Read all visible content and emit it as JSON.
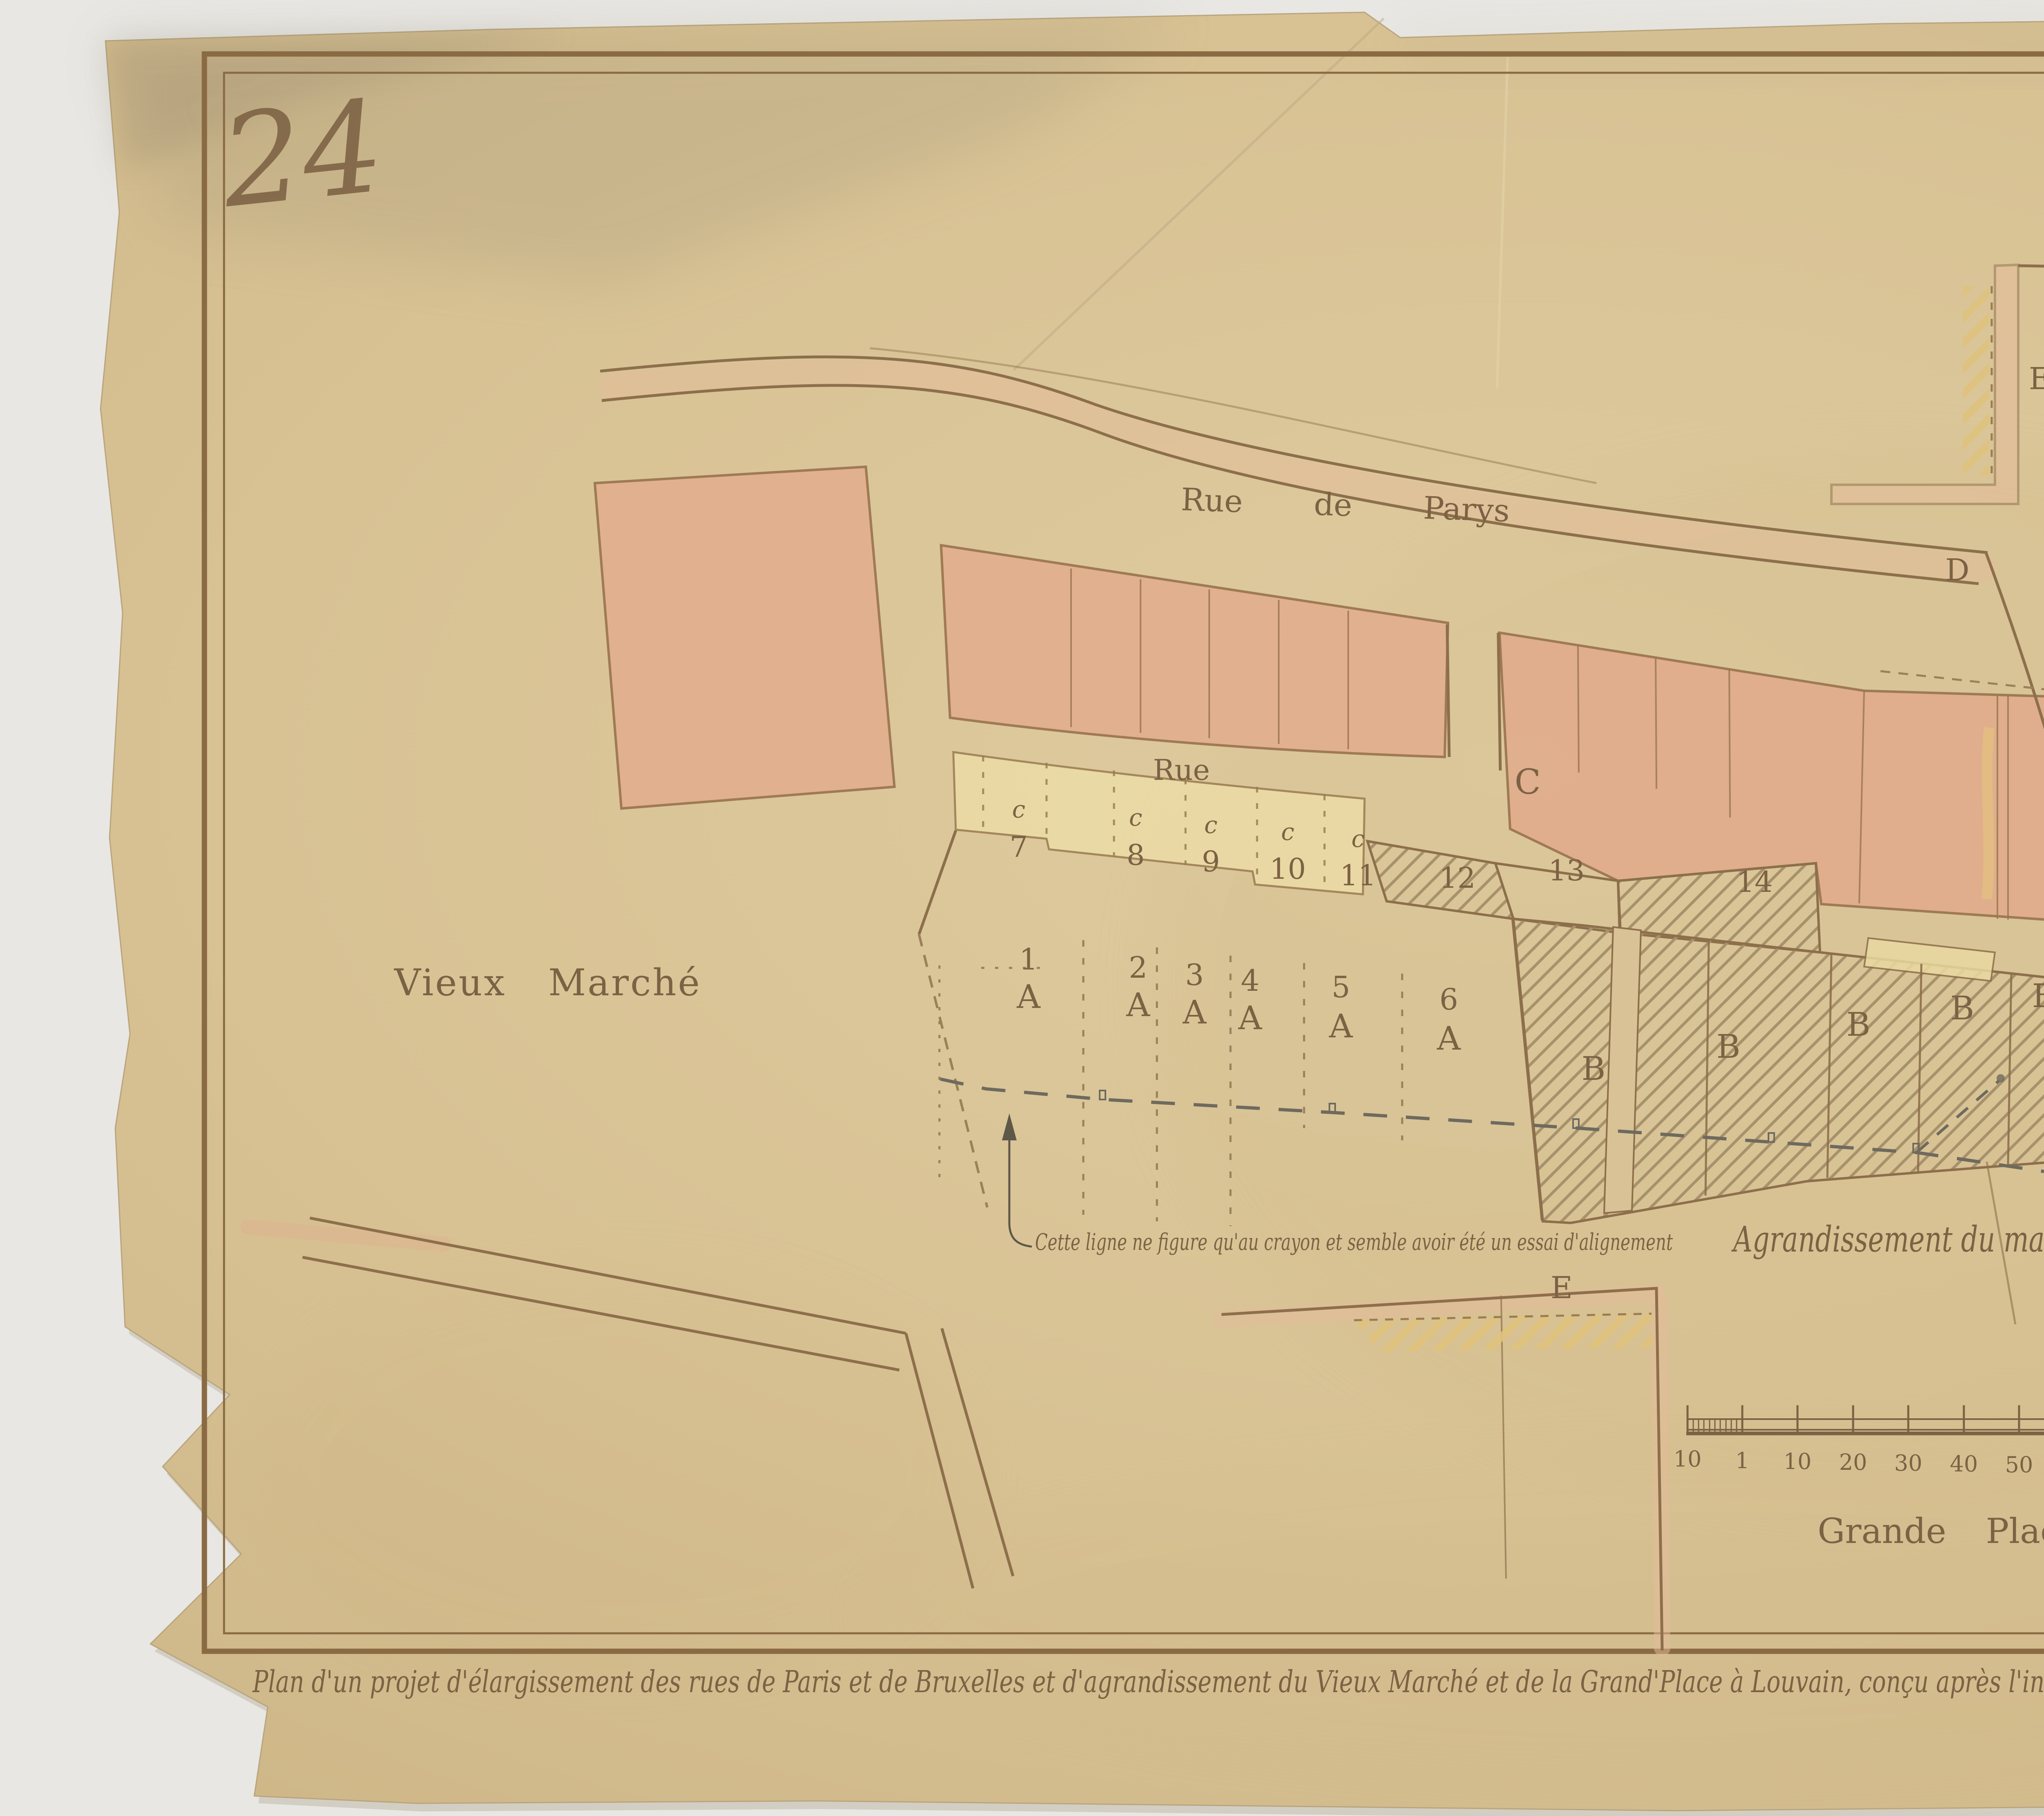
{
  "document": {
    "inventory_marks": {
      "left": "24",
      "right": "24"
    },
    "legend": {
      "items": [
        {
          "key": "A",
          "lines": [
            "Maisons dont le terrein est à aquérir"
          ]
        },
        {
          "key": "B",
          "lines": [
            "Maisons bruleés & dont le terrein est à aquérir."
          ]
        },
        {
          "key": "C",
          "lines": [
            "Terreins & Rues à vendre aux particuliers pour batir"
          ]
        },
        {
          "key": "D",
          "lines": [
            "Terreins à aquerir aussi-tot, pour élargir le passage",
            "& faciliter la communication de la rue de Bruxelles",
            "& de celle de Parys"
          ]
        },
        {
          "key": "E",
          "lines": [
            "Maisons qui devrons reculer fait-a-fait qu'on les",
            "rebatira, pour aligner les Rues"
          ]
        }
      ]
    },
    "caption": {
      "line1": "Plan d'un projet d'élargissement des rues de Paris et de Bruxelles et d'agrandissement du Vieux Marché et de la Grand'Place à Louvain, conçu après l'incendie des maisons formant une des faces de cette place en 1786. (Plan manuscrit n°59).",
      "line2": "Relevé aux Archives générales du Royaume par Mr. Winders Architecte (Janvier 1917)."
    },
    "map": {
      "street_labels": {
        "rue_de_parys": "Rue de Parys",
        "rue": "Rue",
        "rue_de_bruxelles": "Rue de Bruxelles.",
        "vieux_marche": "Vieux Marché",
        "grande_place": "Grande Place"
      },
      "area_labels": {
        "agrandissement": "Agrandissement du marché."
      },
      "note": "Cette ligne ne figure qu'au crayon et semble avoir été un essai d'alignement",
      "plots": {
        "a_row": [
          {
            "n": "1",
            "l": "A"
          },
          {
            "n": "2",
            "l": "A"
          },
          {
            "n": "3",
            "l": "A"
          },
          {
            "n": "4",
            "l": "A"
          },
          {
            "n": "5",
            "l": "A"
          },
          {
            "n": "6",
            "l": "A"
          }
        ],
        "c_row": [
          {
            "l": "c",
            "n": "7"
          },
          {
            "l": "c",
            "n": "8"
          },
          {
            "l": "c",
            "n": "9"
          },
          {
            "l": "c",
            "n": "10"
          },
          {
            "l": "c",
            "n": "11"
          }
        ],
        "numbered": [
          "12",
          "13",
          "14"
        ],
        "b_letters": [
          "B",
          "B",
          "B",
          "B",
          "B"
        ],
        "zone_c": "C",
        "zone_d_upper": "D",
        "zone_d_lower": "D",
        "zone_e_top": "E",
        "zone_e_bottom": "E"
      },
      "scalebar": {
        "ticks": [
          "10",
          "1",
          "10",
          "20",
          "30",
          "40",
          "50",
          "60",
          "70",
          "80"
        ],
        "unit": "pieds"
      }
    },
    "colors": {
      "backdrop": "#e9e7e3",
      "paper": "#d9c498",
      "border_ink": "#8a6a43",
      "text_ink": "#7c6244",
      "blue_crayon": "#4f78b2",
      "pink_wash": "#e2b091",
      "yellow_wash": "#ecdca6"
    }
  }
}
